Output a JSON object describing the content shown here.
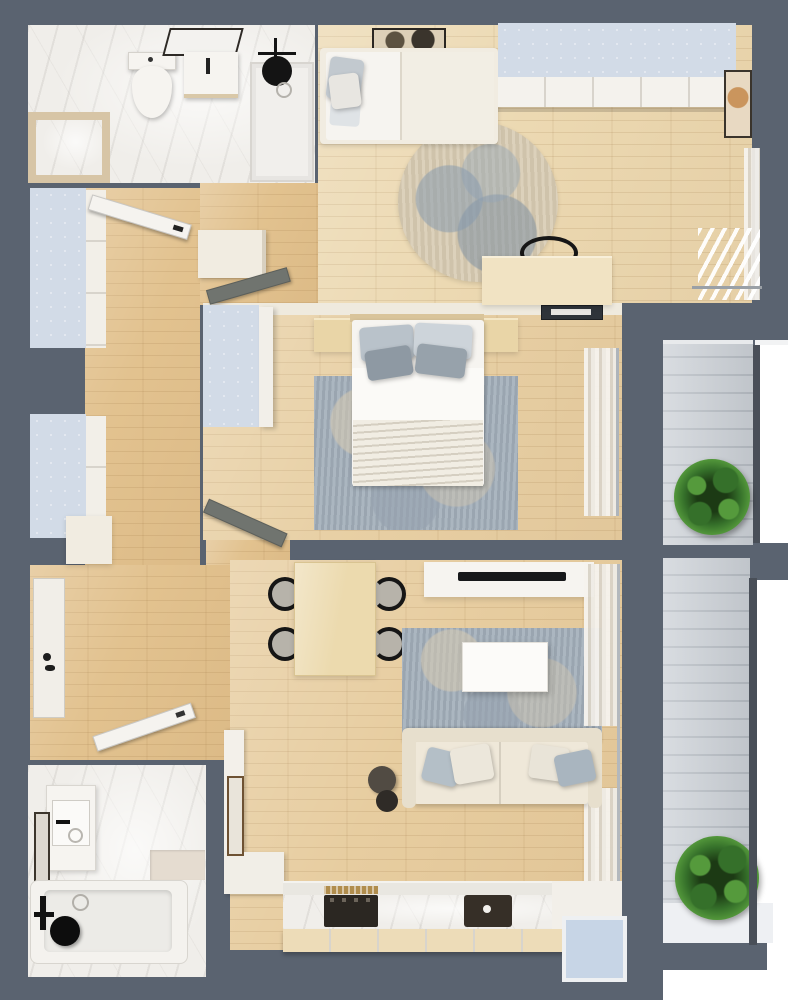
{
  "page": {
    "title": "Apartment floor plan — top-down 3D render",
    "type": "architectural-visualization"
  },
  "colors": {
    "bg": "#ffffff",
    "wall": "#5a6370",
    "wall-dark": "#494f58",
    "wood-hall": "#e2c28f",
    "wood-living": "#e7cda0",
    "wood-kids": "#ecd9b2",
    "wood-master": "#e8d0a5",
    "marble": "#f0eeea",
    "panel-blue": "#d2dbe7",
    "glass-blue": "#c7d5e6",
    "deck": "#ccd1d7",
    "deck-line": "#b6bcc3",
    "cream": "#f1ece1",
    "white-furn": "#f6f4f0",
    "rug-blue": "#a2aeb9",
    "rug-round-base": "#d7cbb2",
    "sofa": "#efe8d9",
    "table-wood": "#ecdaae",
    "counter-front": "#eddcb8",
    "gold": "#b08d4d",
    "black": "#161616",
    "plant-dark": "#1c3a14",
    "plant-mid": "#35702a",
    "plant-light": "#559a3c"
  },
  "floor_plan": {
    "rooms": [
      {
        "name": "bathroom-top-left",
        "floor": "marble",
        "furniture": [
          "toilet",
          "washbasin",
          "vanity-mirror",
          "walk-in-shower",
          "black-shower-head",
          "storage-bench"
        ]
      },
      {
        "name": "kids-bedroom",
        "floor": "wood",
        "furniture": [
          "single-bed",
          "pillows",
          "wall-art",
          "wardrobe",
          "round-rug",
          "desk",
          "desk-chair",
          "picture-frame",
          "window-curtains"
        ]
      },
      {
        "name": "entry-hall",
        "floor": "wood",
        "furniture": [
          "entry-door",
          "tall-wardrobe",
          "tall-wardrobe",
          "hall-closet",
          "console-table"
        ]
      },
      {
        "name": "master-bedroom",
        "floor": "wood",
        "furniture": [
          "double-bed",
          "pillows",
          "nightstand-left",
          "nightstand-right",
          "wardrobe",
          "wall-tv",
          "area-rug",
          "window-curtains",
          "door"
        ]
      },
      {
        "name": "living-room",
        "floor": "wood",
        "furniture": [
          "dining-table",
          "four-chairs",
          "tv-panel",
          "tv",
          "area-rug",
          "coffee-table",
          "sofa",
          "sofa-pillows",
          "side-tables",
          "window-curtains",
          "wall-mirror"
        ]
      },
      {
        "name": "kitchen",
        "floor": "wood",
        "furniture": [
          "counter",
          "cooktop",
          "brass-hood",
          "sink",
          "window"
        ]
      },
      {
        "name": "bathroom-bottom-left",
        "floor": "marble",
        "furniture": [
          "washbasin",
          "wall-mirror",
          "bathtub",
          "black-shower-fixture",
          "shelf"
        ]
      },
      {
        "name": "balcony-top-right",
        "floor": "deck",
        "furniture": [
          "plant"
        ]
      },
      {
        "name": "balcony-bottom-right",
        "floor": "deck",
        "furniture": [
          "plant"
        ]
      }
    ]
  }
}
